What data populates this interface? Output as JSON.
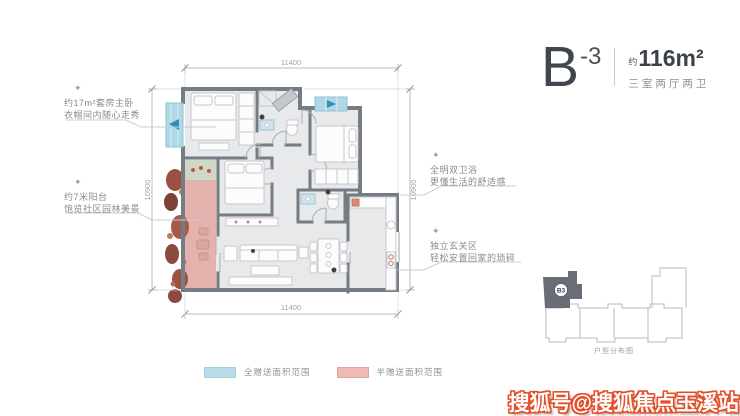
{
  "title_block": {
    "unit": "B",
    "variant": "-3",
    "area_prefix": "约",
    "area": "116m²",
    "layout_type": "三室两厅两卫"
  },
  "annotations": {
    "left_top": {
      "icon": "✦",
      "title": "约17m²套房主卧",
      "subtitle": "衣帽间内随心走秀"
    },
    "left_bottom": {
      "icon": "✦",
      "title": "约7米阳台",
      "subtitle": "饱览社区园林美景"
    },
    "right_top": {
      "icon": "✦",
      "title": "全明双卫浴",
      "subtitle": "更懂生活的舒适感"
    },
    "right_bottom": {
      "icon": "✦",
      "title": "独立玄关区",
      "subtitle": "轻松安置回家的琐碎"
    }
  },
  "dimensions": {
    "top": "11400",
    "bottom": "11400",
    "left": "10900",
    "right": "10900"
  },
  "legend": {
    "full_area": {
      "label": "全赠送面积范围",
      "color": "#b9dce8"
    },
    "half_area": {
      "label": "半赠送面积范围",
      "color": "#f0b9b3"
    }
  },
  "key_plan": {
    "marker": "B3",
    "caption": "户型分布图",
    "highlight_color": "#686e75"
  },
  "watermark": {
    "text": "搜狐号@搜狐焦点玉溪站",
    "color": "#e44d27"
  },
  "palette": {
    "wall": "#757c84",
    "floor": "#e8e9eb",
    "bay_window": "#aed8e6",
    "balcony": "#e3b2ac",
    "plants": "#9c4f43",
    "dimension_text": "#9aa1a8"
  }
}
